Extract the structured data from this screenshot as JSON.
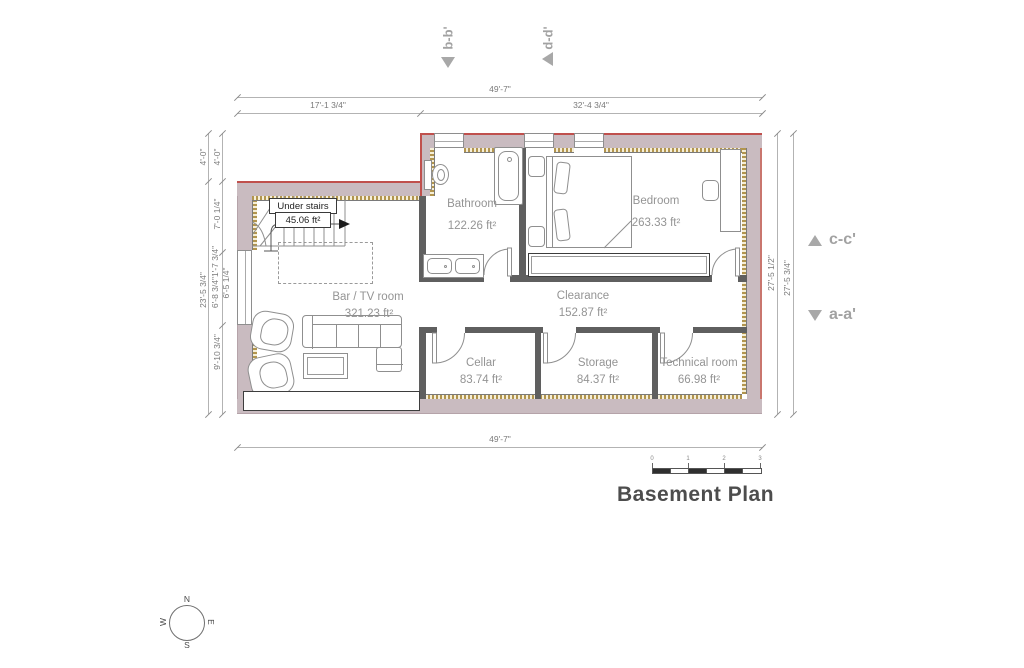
{
  "title": {
    "text": "Basement Plan"
  },
  "rooms": {
    "under_stairs": {
      "name": "Under stairs",
      "area": "45.06 ft²"
    },
    "bathroom": {
      "name": "Bathroom",
      "area": "122.26 ft²"
    },
    "bedroom": {
      "name": "Bedroom",
      "area": "263.33 ft²"
    },
    "bar_tv": {
      "name": "Bar / TV room",
      "area": "321.23 ft²"
    },
    "clearance": {
      "name": "Clearance",
      "area": "152.87 ft²"
    },
    "cellar": {
      "name": "Cellar",
      "area": "83.74 ft²"
    },
    "storage": {
      "name": "Storage",
      "area": "84.37 ft²"
    },
    "technical": {
      "name": "Technical room",
      "area": "66.98 ft²"
    }
  },
  "dims": {
    "top_total": "49'-7\"",
    "top_seg1": "17'-1 3/4\"",
    "top_seg2": "32'-4 3/4\"",
    "bottom_total": "49'-7\"",
    "left_outer": [
      "4'-0\"",
      "23'-5 3/4\""
    ],
    "left_inner": [
      "4'-0\"",
      "7'-0 1/4\"",
      "6'-8 3/4\"",
      "1'-7 3/4\"",
      "6'-5 1/4\"",
      "9'-10 3/4\""
    ],
    "right": [
      "27'-5 1/2\"",
      "27'-5 3/4\""
    ]
  },
  "section_markers": {
    "b": "b-b'",
    "d": "d-d'",
    "c": "c-c'",
    "a": "a-a'"
  },
  "compass": {
    "n": "N",
    "s": "S",
    "e": "E",
    "w": "W"
  },
  "scale_bar": {
    "ticks": [
      "0",
      "1",
      "2",
      "3"
    ]
  },
  "colors": {
    "outer_wall": "#c9bbc0",
    "exterior_line_red": "#c0504d",
    "insulation": "#b2954e",
    "interior_wall": "#5f5f5f",
    "room_label": "#949494",
    "dimension": "#7a7a7a",
    "marker": "#a2a2a2"
  }
}
